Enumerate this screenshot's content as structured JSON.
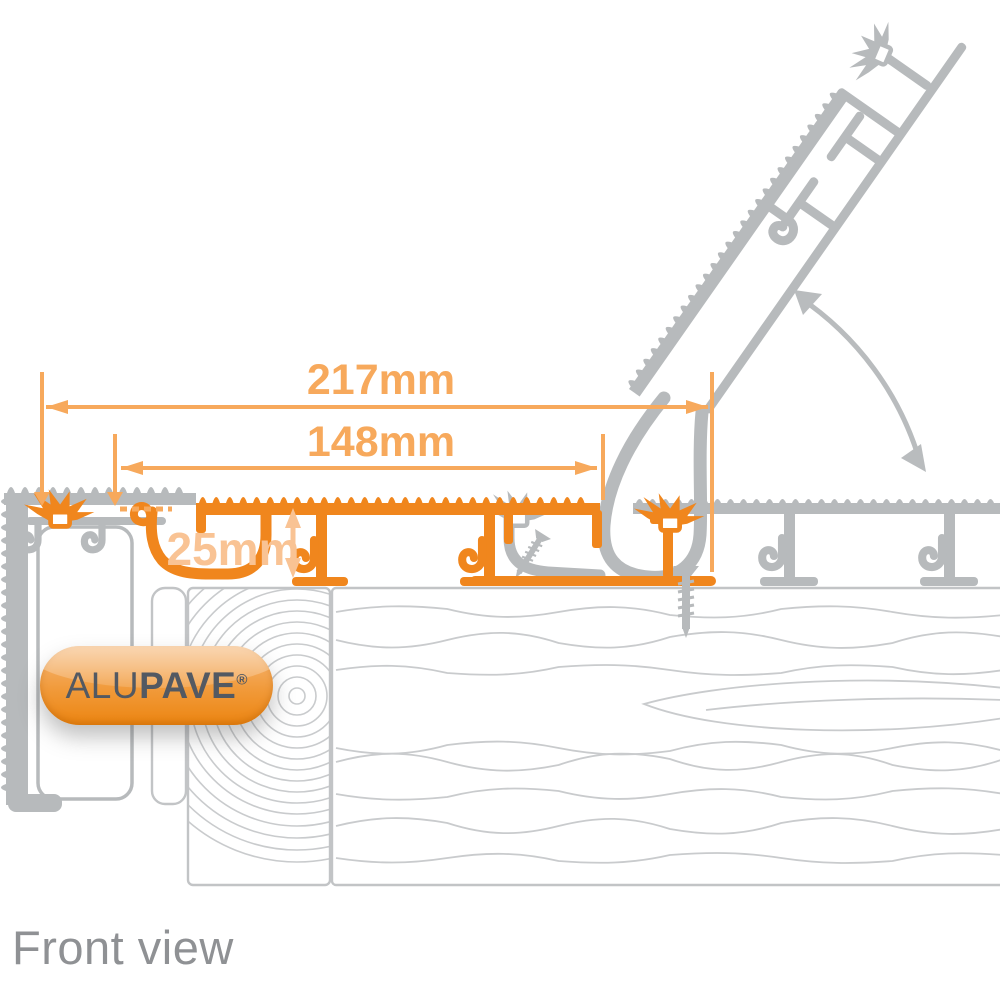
{
  "view_label": "Front view",
  "logo": {
    "alu": "ALU",
    "pave": "PAVE",
    "reg": "®"
  },
  "dimensions": {
    "overall": {
      "label": "217mm"
    },
    "board": {
      "label": "148mm"
    },
    "height": {
      "label": "25mm"
    }
  },
  "colors": {
    "profile_orange": "#F0861D",
    "dimension_orange": "#F7A95C",
    "pale_orange": "#F9C394",
    "profile_gray": "#B7BABC",
    "wood_gray": "#C9CBCD",
    "label_gray": "#8F9194",
    "logo_text": "#535962",
    "logo_gradient_top": "#F6BA7C",
    "logo_gradient_bottom": "#EC8511"
  }
}
